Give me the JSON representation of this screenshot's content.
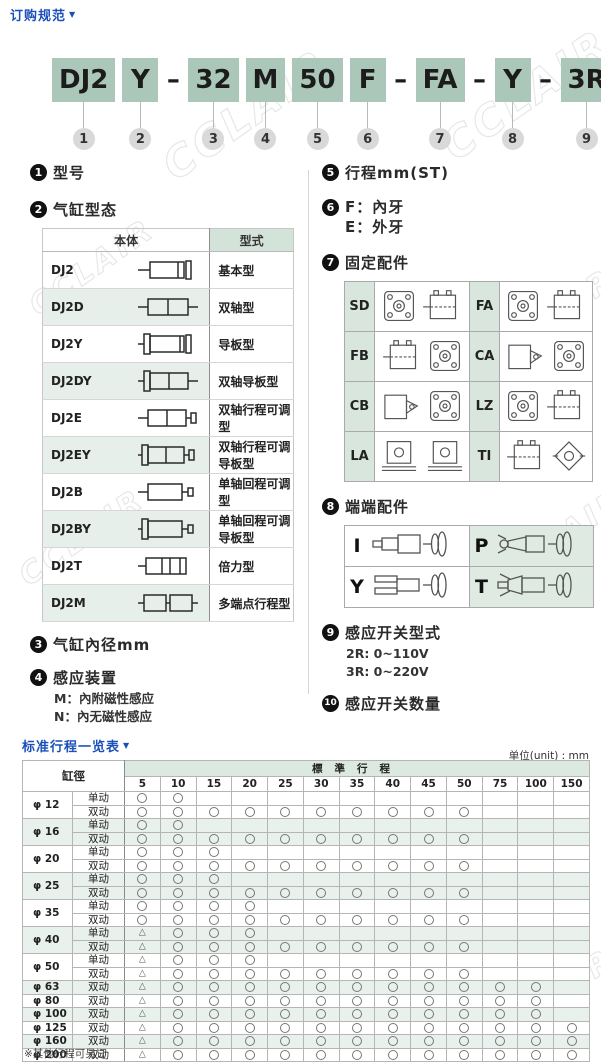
{
  "header": {
    "title": "订购规范",
    "arrow": "▼"
  },
  "watermark": "CCLAIR",
  "model_code": {
    "segments": [
      {
        "text": "DJ2",
        "boxed": true,
        "num": "1"
      },
      {
        "text": "Y",
        "boxed": true,
        "num": "2"
      },
      {
        "text": "–",
        "boxed": false,
        "num": ""
      },
      {
        "text": "32",
        "boxed": true,
        "num": "3"
      },
      {
        "text": "M",
        "boxed": true,
        "num": "4"
      },
      {
        "text": "50",
        "boxed": true,
        "num": "5"
      },
      {
        "text": "F",
        "boxed": true,
        "num": "6"
      },
      {
        "text": "–",
        "boxed": false,
        "num": ""
      },
      {
        "text": "FA",
        "boxed": true,
        "num": "7"
      },
      {
        "text": "–",
        "boxed": false,
        "num": ""
      },
      {
        "text": "Y",
        "boxed": true,
        "num": "8"
      },
      {
        "text": "–",
        "boxed": false,
        "num": ""
      },
      {
        "text": "3R",
        "boxed": true,
        "num": "9"
      },
      {
        "text": "2",
        "boxed": true,
        "num": "10"
      }
    ]
  },
  "sections": {
    "s1": {
      "num": "1",
      "title": "型号"
    },
    "s2": {
      "num": "2",
      "title": "气缸型态"
    },
    "s3": {
      "num": "3",
      "title": "气缸內径mm"
    },
    "s4": {
      "num": "4",
      "title": "感应装置",
      "lines": [
        "M：內附磁性感应",
        "N：內无磁性感应"
      ]
    },
    "s5": {
      "num": "5",
      "title": "行程mm(ST)"
    },
    "s6": {
      "num": "6",
      "lines": [
        "F：內牙",
        "E：外牙"
      ]
    },
    "s7": {
      "num": "7",
      "title": "固定配件",
      "labels": [
        "SD",
        "FA",
        "FB",
        "CA",
        "CB",
        "LZ",
        "LA",
        "TI"
      ]
    },
    "s8": {
      "num": "8",
      "title": "端端配件",
      "labels": [
        "I",
        "P",
        "Y",
        "T"
      ]
    },
    "s9": {
      "num": "9",
      "title": "感应开关型式",
      "lines": [
        "2R: 0~110V",
        "3R: 0~220V"
      ]
    },
    "s10": {
      "num": "10",
      "title": "感应开关数量"
    }
  },
  "type_table": {
    "header_body": "本体",
    "header_type": "型式",
    "rows": [
      {
        "code": "DJ2",
        "type": "基本型"
      },
      {
        "code": "DJ2D",
        "type": "双轴型"
      },
      {
        "code": "DJ2Y",
        "type": "导板型"
      },
      {
        "code": "DJ2DY",
        "type": "双轴导板型"
      },
      {
        "code": "DJ2E",
        "type": "双轴行程可调型"
      },
      {
        "code": "DJ2EY",
        "type": "双轴行程可调导板型"
      },
      {
        "code": "DJ2B",
        "type": "单轴回程可调型"
      },
      {
        "code": "DJ2BY",
        "type": "单轴回程可调导板型"
      },
      {
        "code": "DJ2T",
        "type": "倍力型"
      },
      {
        "code": "DJ2M",
        "type": "多端点行程型"
      }
    ]
  },
  "stroke_table": {
    "title": "标准行程一览表",
    "arrow": "▼",
    "unit": "单位(unit) : mm",
    "corner_header": "缸徑",
    "band_header": "標準行程",
    "columns": [
      "5",
      "10",
      "15",
      "20",
      "25",
      "30",
      "35",
      "40",
      "45",
      "50",
      "75",
      "100",
      "150"
    ],
    "legend": {
      "O": "标准供货(○)",
      "T": "可选(△)"
    },
    "groups": [
      {
        "bore": "φ 12",
        "tint": false,
        "rows": [
          {
            "action": "单动",
            "marks": "OO..........."
          },
          {
            "action": "双动",
            "marks": "OOOOOOOOOO..."
          }
        ]
      },
      {
        "bore": "φ 16",
        "tint": true,
        "rows": [
          {
            "action": "单动",
            "marks": "OO..........."
          },
          {
            "action": "双动",
            "marks": "OOOOOOOOOO..."
          }
        ]
      },
      {
        "bore": "φ 20",
        "tint": false,
        "rows": [
          {
            "action": "单动",
            "marks": "OOO.........."
          },
          {
            "action": "双动",
            "marks": "OOOOOOOOOO..."
          }
        ]
      },
      {
        "bore": "φ 25",
        "tint": true,
        "rows": [
          {
            "action": "单动",
            "marks": "OOO.........."
          },
          {
            "action": "双动",
            "marks": "OOOOOOOOOO..."
          }
        ]
      },
      {
        "bore": "φ 35",
        "tint": false,
        "rows": [
          {
            "action": "单动",
            "marks": "OOOO........."
          },
          {
            "action": "双动",
            "marks": "OOOOOOOOOO..."
          }
        ]
      },
      {
        "bore": "φ 40",
        "tint": true,
        "rows": [
          {
            "action": "单动",
            "marks": "TOOO........."
          },
          {
            "action": "双动",
            "marks": "TOOOOOOOOO..."
          }
        ]
      },
      {
        "bore": "φ 50",
        "tint": false,
        "rows": [
          {
            "action": "单动",
            "marks": "TOOO........."
          },
          {
            "action": "双动",
            "marks": "TOOOOOOOOO..."
          }
        ]
      },
      {
        "bore": "φ 63",
        "tint": true,
        "rows": [
          {
            "action": "双动",
            "marks": "TOOOOOOOOOOO."
          }
        ]
      },
      {
        "bore": "φ 80",
        "tint": false,
        "rows": [
          {
            "action": "双动",
            "marks": "TOOOOOOOOOOO."
          }
        ]
      },
      {
        "bore": "φ 100",
        "tint": true,
        "rows": [
          {
            "action": "双动",
            "marks": "TOOOOOOOOOOO."
          }
        ]
      },
      {
        "bore": "φ 125",
        "tint": false,
        "rows": [
          {
            "action": "双动",
            "marks": "TOOOOOOOOOOOO"
          }
        ]
      },
      {
        "bore": "φ 160",
        "tint": true,
        "rows": [
          {
            "action": "双动",
            "marks": "TOOOOOOOOOOOO"
          }
        ]
      },
      {
        "bore": "φ 200",
        "tint": false,
        "rows": [
          {
            "action": "双动",
            "marks": "TOOOOOOOOOOOO"
          }
        ]
      }
    ],
    "footnote": "※其他行程可另订"
  },
  "colors": {
    "accent_blue": "#1b50bb",
    "model_box_green": "#abc7ba",
    "tint_green": "#e6efe9",
    "header_green": "#d4e3da",
    "number_circle_gray": "#d9d9d9"
  }
}
